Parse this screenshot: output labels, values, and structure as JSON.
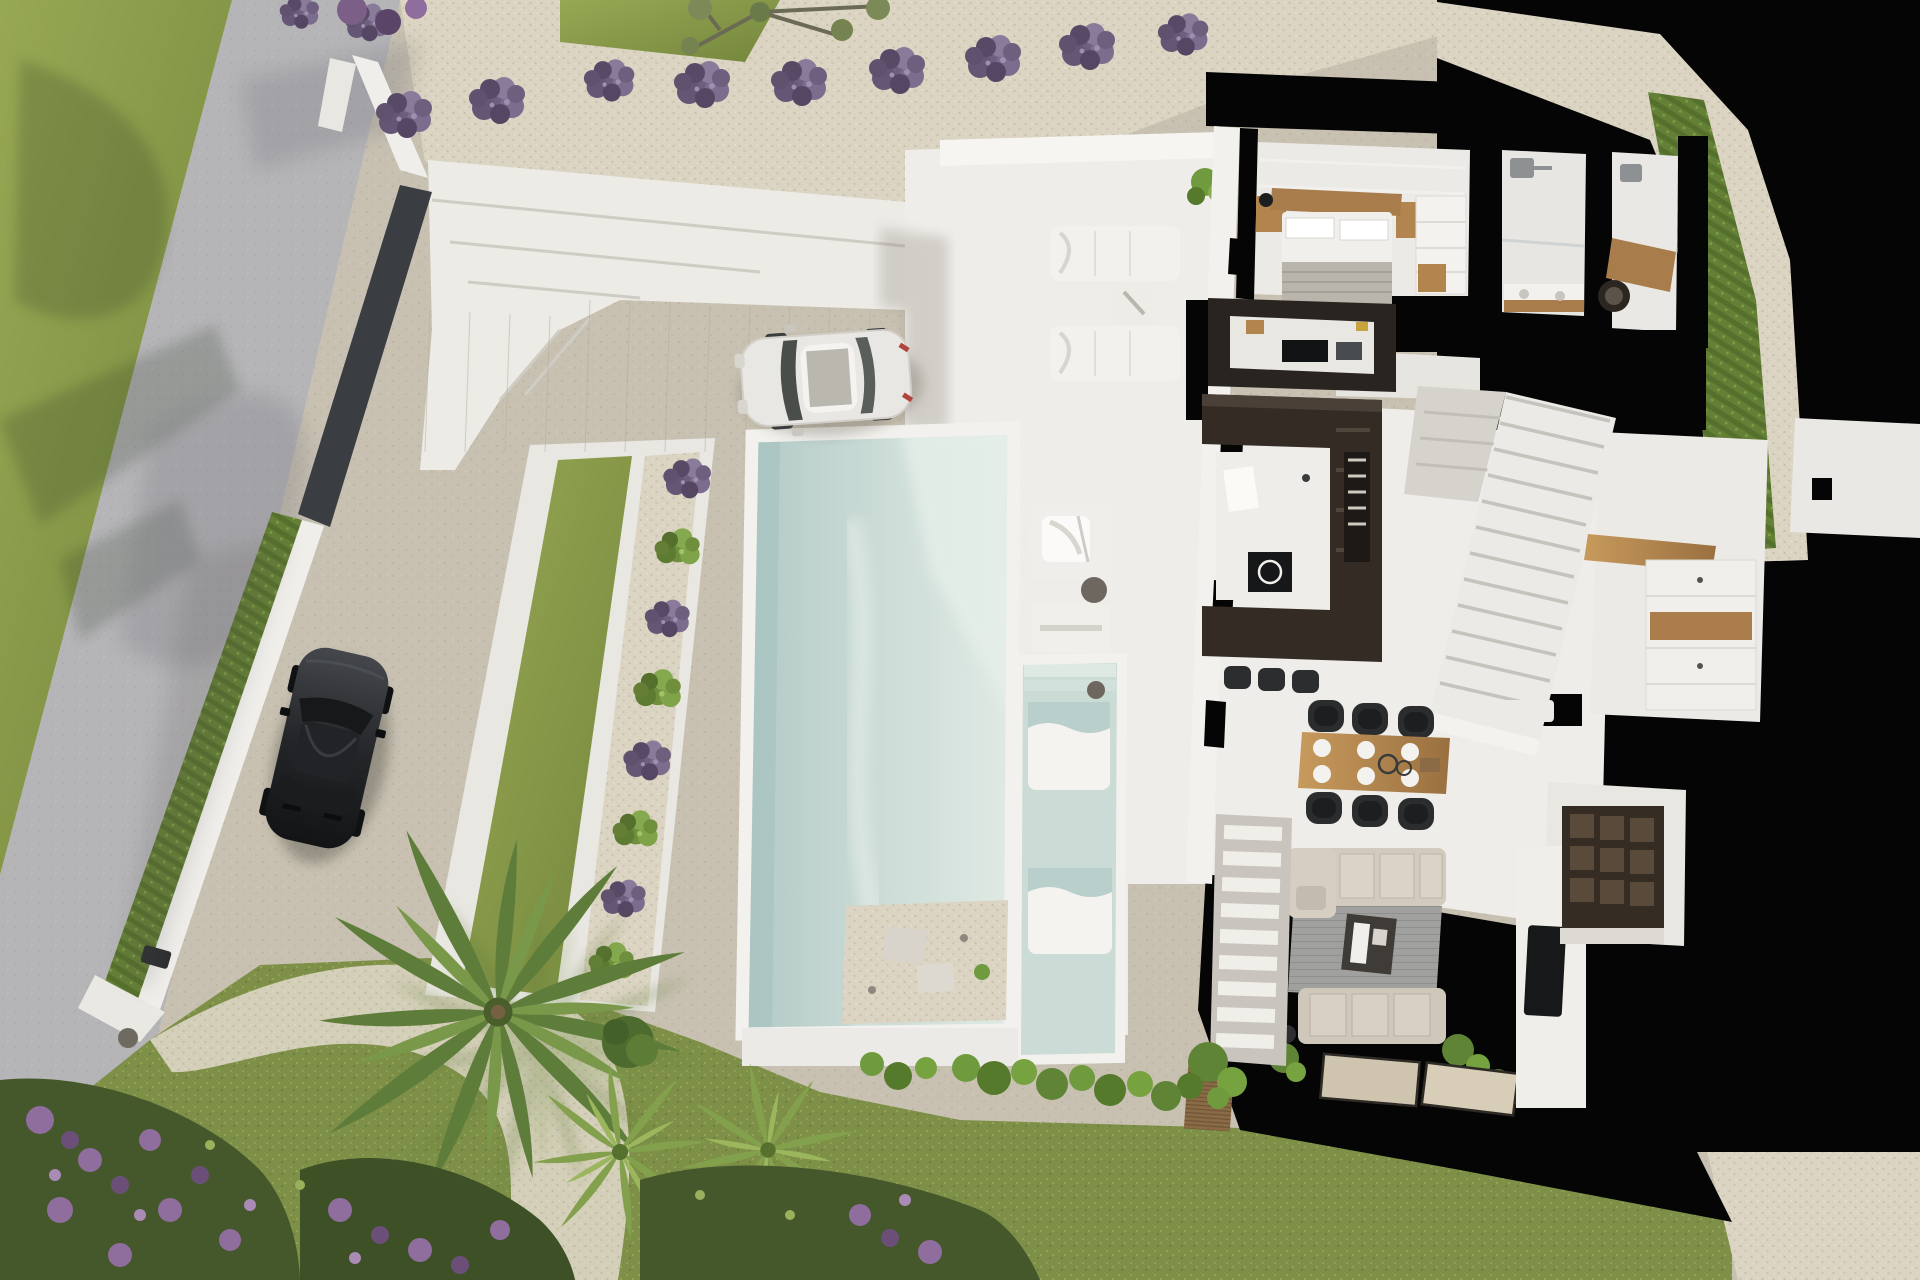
{
  "meta": {
    "title": "Aerial 3D cutaway render of a modern villa plot with pool and garden",
    "view": "top-down bird's eye",
    "visible_text": "none"
  },
  "palette": {
    "lawn": "#87993f",
    "rear_grass": "#7e9048",
    "road": "#b5b4b7",
    "stone_path": "#dbd4c2",
    "driveway_gravel": "#c8c1b2",
    "pool_water": "#c6d9d6",
    "pool_deep": "#a9c4c2",
    "white_surfaces": "#efede9",
    "cut_walls_black": "#050505",
    "dark_boundary_wall": "#3a3d41",
    "hedge_green": "#647f36",
    "lavender": "#6e5f7e",
    "wood": "#b3854e",
    "kitchen_dark": "#2a2420",
    "sofa_beige": "#d2cabd",
    "rug_gray": "#9e9e9c",
    "black_car": "#26282b",
    "white_car": "#e9e7e3",
    "flower_purple": "#8f6d9c"
  },
  "labels": {
    "site": "villa site plan",
    "road": "access road",
    "roadside_lawn": "roadside lawn with tree shadows",
    "boundary_wall": "white boundary wall",
    "gate_wall": "dark entrance gate wall",
    "hedge": "boundary hedge row",
    "wall_light": "wall spotlight",
    "parking": "gravel parking and driveway",
    "black_car": "parked black car",
    "white_car": "parked white car",
    "terrace": "stepped white entry terrace",
    "stone_path": "stone footpath with lavender",
    "lavender_row": "row of lavender bushes",
    "olive_tree": "olive tree by the road",
    "lawn_strip": "bordered lawn strip",
    "shrub_row": "alternating lavender and green shrubs",
    "pool": "main swimming pool",
    "kids_pool": "shallow pool with submerged loungers",
    "deck": "white pool deck",
    "deck_loungers": "pair of sun loungers with side table",
    "armchair": "outdoor lounge chair platform",
    "console": "outdoor console table",
    "villa": "villa interior cutaway",
    "bedroom": "master bedroom",
    "bed": "double bed with wood headboard",
    "wardrobe": "fitted wardrobe",
    "bathroom1": "bathroom with shower and vanity",
    "bathroom2": "bathroom with round basin",
    "kitchen": "dark U-shaped kitchen with island",
    "island": "kitchen island with cooktop",
    "stools": "bar stools",
    "stairs": "white staircase",
    "hallway": "hallway with wardrobe cabinets",
    "sideboard": "wooden sideboard",
    "dining": "dining table for six",
    "bench": "white bench",
    "living": "living room with sofas and rug",
    "tv": "TV on media wall",
    "closet": "utility room with dark shelving",
    "entry_steps": "exterior entrance steps",
    "planter": "wooden planter with shrubs",
    "palms": "palm trees",
    "flowers": "purple flowering border",
    "rear_lawn": "rear lawn",
    "gravel_patch": "gravel patch"
  },
  "counts": {
    "lavender_bushes_top": 9,
    "garden_shrubs": 8,
    "deck_loungers": 2,
    "in_pool_loungers": 2,
    "dining_chairs": 6,
    "bar_stools": 3,
    "palm_trees": 3,
    "parked_cars": 2,
    "doormats": 2
  }
}
